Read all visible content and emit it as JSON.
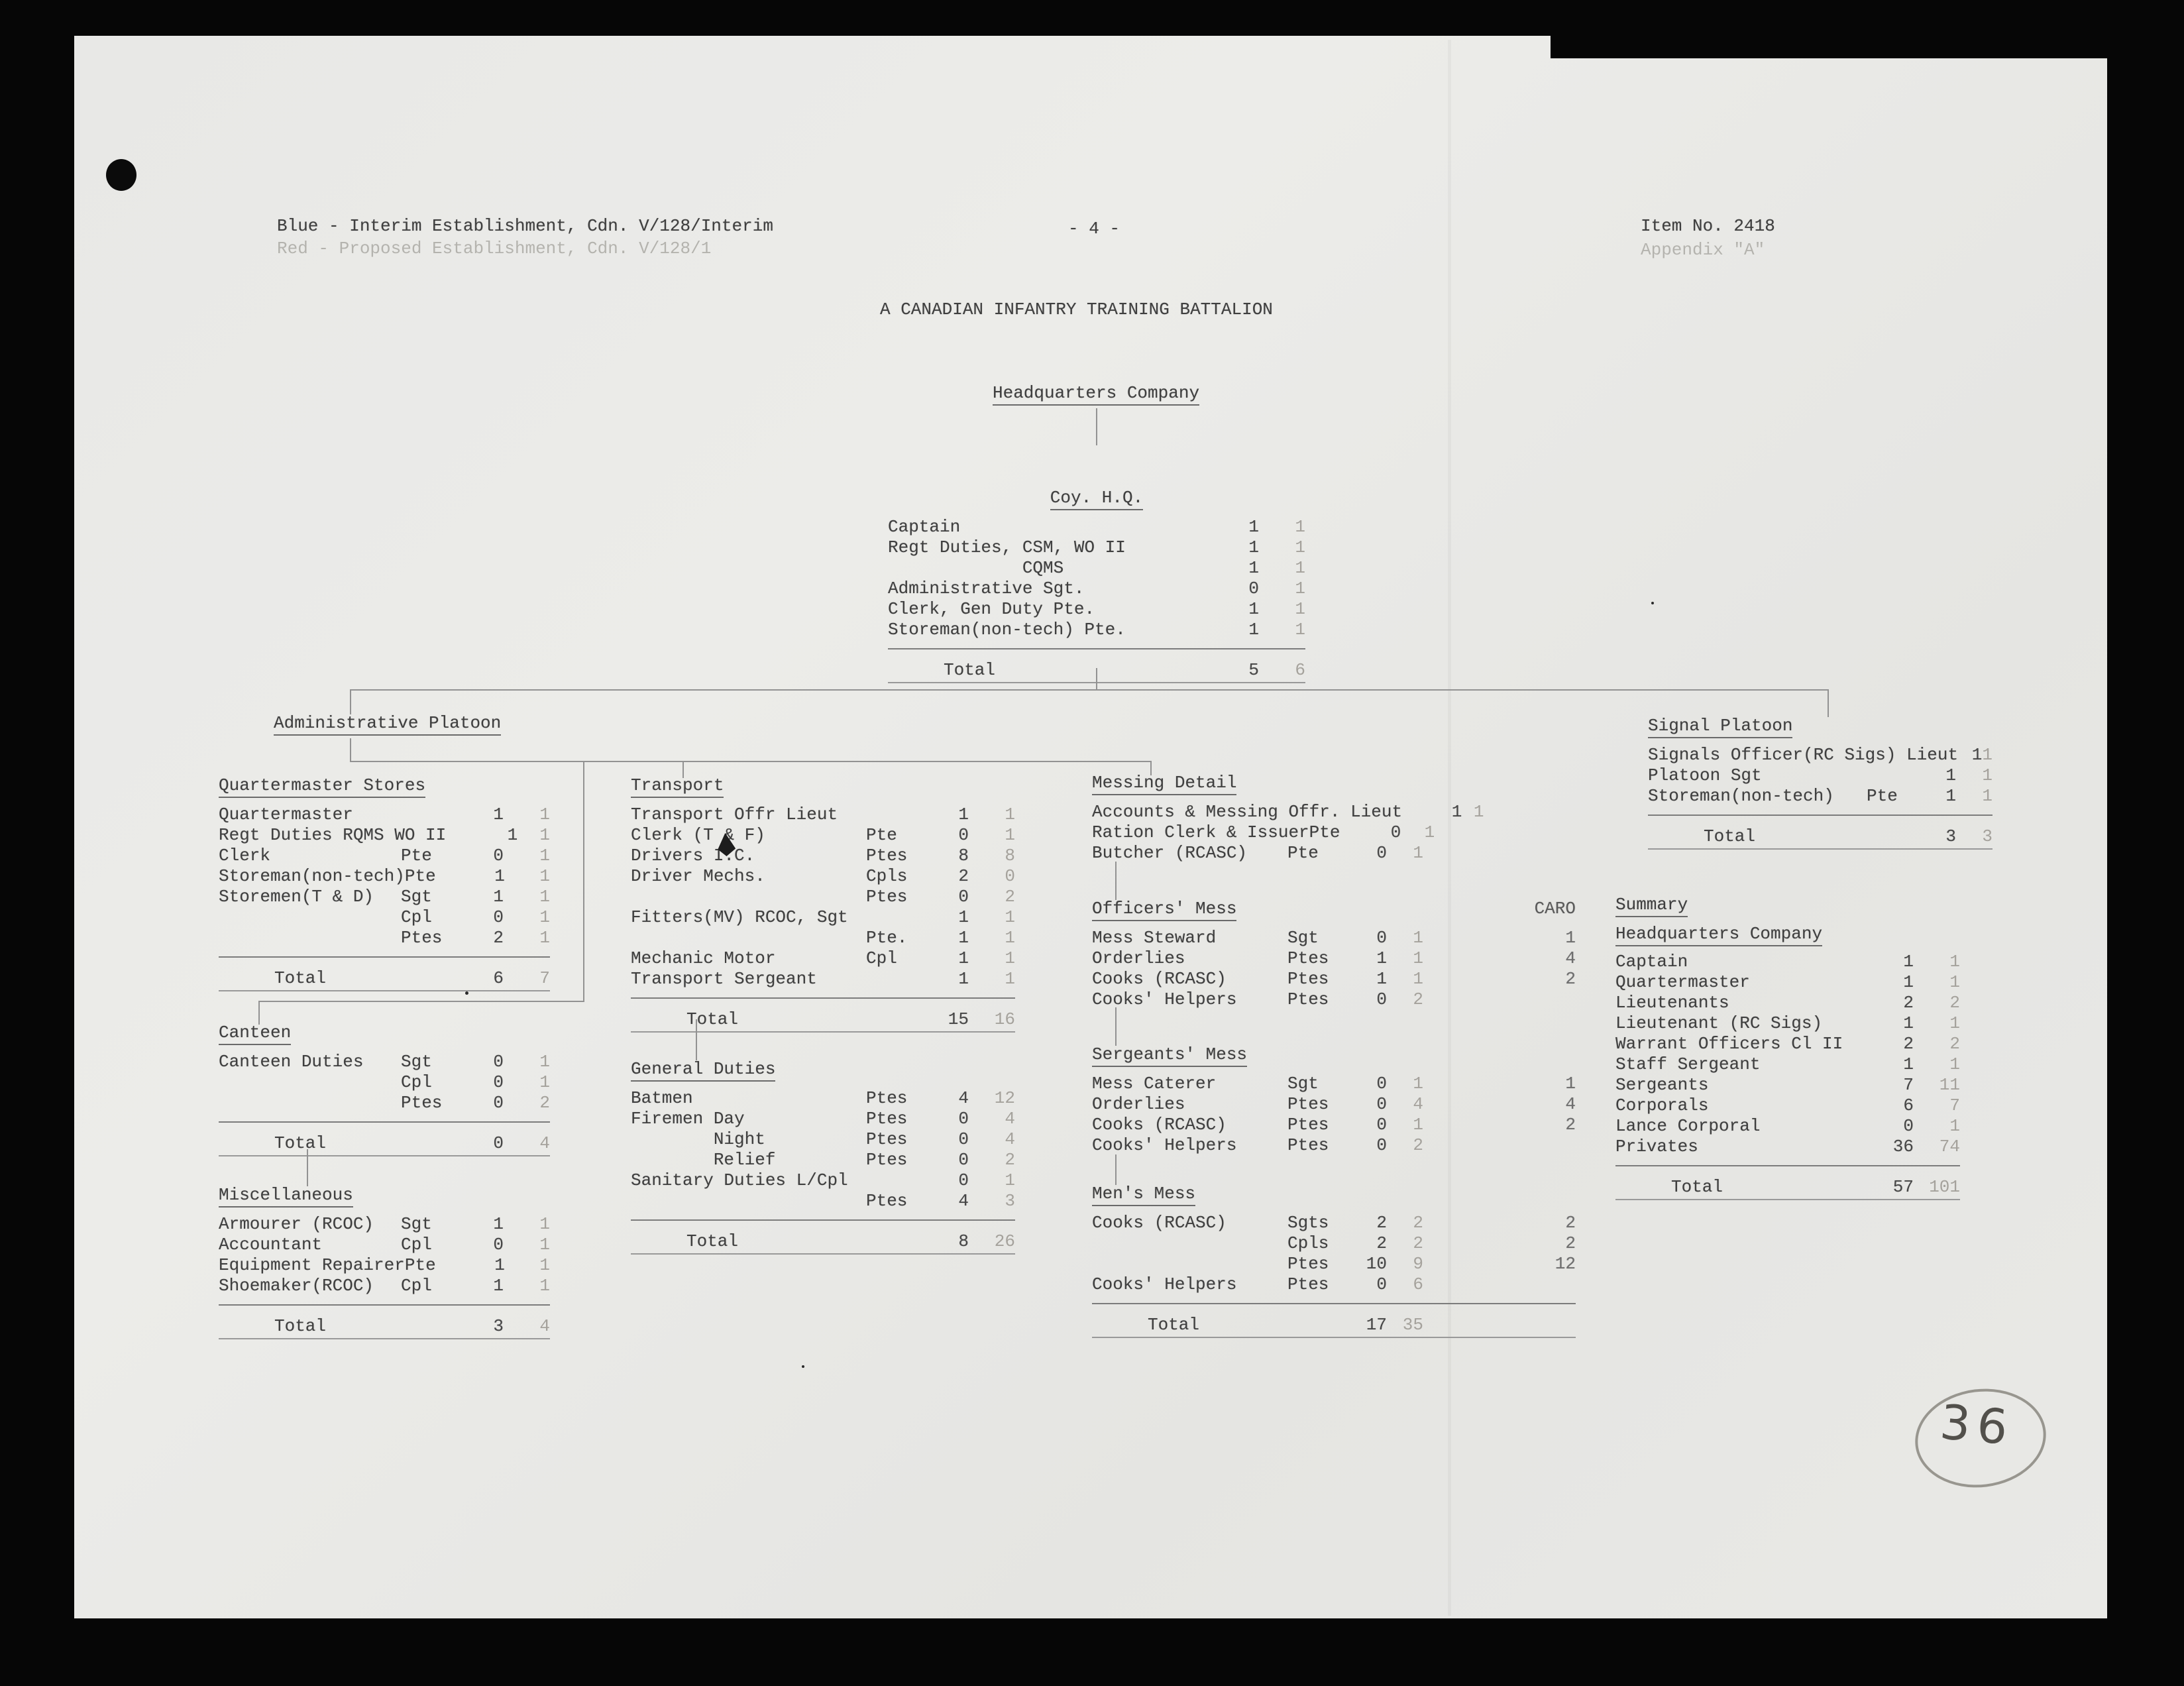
{
  "header": {
    "left_line1": "Blue - Interim Establishment, Cdn. V/128/Interim",
    "left_line2": "Red - Proposed Establishment, Cdn. V/128/1",
    "page_number": "- 4 -",
    "right_line1": "Item No. 2418",
    "right_line2": "Appendix \"A\""
  },
  "title": "A CANADIAN INFANTRY TRAINING BATTALION",
  "org_labels": {
    "hq_company": "Headquarters Company",
    "admin_platoon": "Administrative Platoon"
  },
  "handwritten_note": "36",
  "colors": {
    "paper": "#e8e8e6",
    "ink": "#3f3f3f",
    "faint_ink": "#a5a29c",
    "pencil": "#52504b",
    "frame": "#060606"
  },
  "sections": {
    "coy_hq": {
      "title": "Coy. H.Q.",
      "rows": [
        {
          "label": "Captain",
          "rank": "",
          "c1": "1",
          "c2": "1"
        },
        {
          "label": "Regt Duties, CSM, WO II",
          "rank": "",
          "c1": "1",
          "c2": "1"
        },
        {
          "label": "             CQMS",
          "rank": "",
          "c1": "1",
          "c2": "1"
        },
        {
          "label": "Administrative Sgt.",
          "rank": "",
          "c1": "0",
          "c2": "1"
        },
        {
          "label": "Clerk, Gen Duty Pte.",
          "rank": "",
          "c1": "1",
          "c2": "1"
        },
        {
          "label": "Storeman(non-tech) Pte.",
          "rank": "",
          "c1": "1",
          "c2": "1"
        }
      ],
      "total": {
        "label": "Total",
        "c1": "5",
        "c2": "6"
      }
    },
    "quartermaster_stores": {
      "title": "Quartermaster Stores",
      "rows": [
        {
          "label": "Quartermaster",
          "rank": "",
          "c1": "1",
          "c2": "1"
        },
        {
          "label": "Regt Duties RQMS WO II",
          "rank": "",
          "c1": "1",
          "c2": "1"
        },
        {
          "label": "Clerk",
          "rank": "Pte",
          "c1": "0",
          "c2": "1"
        },
        {
          "label": "Storeman(non-tech)",
          "rank": "Pte",
          "c1": "1",
          "c2": "1"
        },
        {
          "label": "Storemen(T & D)",
          "rank": "Sgt",
          "c1": "1",
          "c2": "1"
        },
        {
          "label": "",
          "rank": "Cpl",
          "c1": "0",
          "c2": "1"
        },
        {
          "label": "",
          "rank": "Ptes",
          "c1": "2",
          "c2": "1"
        }
      ],
      "total": {
        "label": "Total",
        "c1": "6",
        "c2": "7"
      }
    },
    "canteen": {
      "title": "Canteen",
      "rows": [
        {
          "label": "Canteen Duties",
          "rank": "Sgt",
          "c1": "0",
          "c2": "1"
        },
        {
          "label": "",
          "rank": "Cpl",
          "c1": "0",
          "c2": "1"
        },
        {
          "label": "",
          "rank": "Ptes",
          "c1": "0",
          "c2": "2"
        }
      ],
      "total": {
        "label": "Total",
        "c1": "0",
        "c2": "4"
      }
    },
    "miscellaneous": {
      "title": "Miscellaneous",
      "rows": [
        {
          "label": "Armourer (RCOC)",
          "rank": "Sgt",
          "c1": "1",
          "c2": "1"
        },
        {
          "label": "Accountant",
          "rank": "Cpl",
          "c1": "0",
          "c2": "1"
        },
        {
          "label": "Equipment Repairer",
          "rank": "Pte",
          "c1": "1",
          "c2": "1"
        },
        {
          "label": "Shoemaker(RCOC)",
          "rank": "Cpl",
          "c1": "1",
          "c2": "1"
        }
      ],
      "total": {
        "label": "Total",
        "c1": "3",
        "c2": "4"
      }
    },
    "transport": {
      "title": "Transport",
      "rows": [
        {
          "label": "Transport Offr Lieut",
          "rank": "",
          "c1": "1",
          "c2": "1"
        },
        {
          "label": "Clerk (T & F)",
          "rank": "Pte",
          "c1": "0",
          "c2": "1"
        },
        {
          "label": "Drivers I.C.",
          "rank": "Ptes",
          "c1": "8",
          "c2": "8"
        },
        {
          "label": "Driver Mechs.",
          "rank": "Cpls",
          "c1": "2",
          "c2": "0"
        },
        {
          "label": "",
          "rank": "Ptes",
          "c1": "0",
          "c2": "2"
        },
        {
          "label": "Fitters(MV) RCOC, Sgt",
          "rank": "",
          "c1": "1",
          "c2": "1"
        },
        {
          "label": "",
          "rank": "Pte.",
          "c1": "1",
          "c2": "1"
        },
        {
          "label": "Mechanic Motor",
          "rank": "Cpl",
          "c1": "1",
          "c2": "1"
        },
        {
          "label": "Transport Sergeant",
          "rank": "",
          "c1": "1",
          "c2": "1"
        }
      ],
      "total": {
        "label": "Total",
        "c1": "15",
        "c2": "16"
      }
    },
    "general_duties": {
      "title": "General Duties",
      "rows": [
        {
          "label": "Batmen",
          "rank": "Ptes",
          "c1": "4",
          "c2": "12"
        },
        {
          "label": "Firemen Day",
          "rank": "Ptes",
          "c1": "0",
          "c2": "4"
        },
        {
          "label": "        Night",
          "rank": "Ptes",
          "c1": "0",
          "c2": "4"
        },
        {
          "label": "        Relief",
          "rank": "Ptes",
          "c1": "0",
          "c2": "2"
        },
        {
          "label": "Sanitary Duties L/Cpl",
          "rank": "",
          "c1": "0",
          "c2": "1"
        },
        {
          "label": "",
          "rank": "Ptes",
          "c1": "4",
          "c2": "3"
        }
      ],
      "total": {
        "label": "Total",
        "c1": "8",
        "c2": "26"
      }
    },
    "messing_detail": {
      "title": "Messing Detail",
      "rows": [
        {
          "label": "Accounts & Messing Offr. Lieut",
          "rank": "",
          "c1": "1",
          "c2": "1",
          "caro": ""
        },
        {
          "label": "Ration Clerk & Issuer",
          "rank": "Pte",
          "c1": "0",
          "c2": "1",
          "caro": ""
        },
        {
          "label": "Butcher (RCASC)",
          "rank": "Pte",
          "c1": "0",
          "c2": "1",
          "caro": ""
        }
      ]
    },
    "officers_mess": {
      "title": "Officers' Mess",
      "caro_header": "CARO",
      "rows": [
        {
          "label": "Mess Steward",
          "rank": "Sgt",
          "c1": "0",
          "c2": "1",
          "caro": "1"
        },
        {
          "label": "Orderlies",
          "rank": "Ptes",
          "c1": "1",
          "c2": "1",
          "caro": "4"
        },
        {
          "label": "Cooks (RCASC)",
          "rank": "Ptes",
          "c1": "1",
          "c2": "1",
          "caro": "2"
        },
        {
          "label": "Cooks' Helpers",
          "rank": "Ptes",
          "c1": "0",
          "c2": "2",
          "caro": ""
        }
      ]
    },
    "sergeants_mess": {
      "title": "Sergeants' Mess",
      "rows": [
        {
          "label": "Mess Caterer",
          "rank": "Sgt",
          "c1": "0",
          "c2": "1",
          "caro": "1"
        },
        {
          "label": "Orderlies",
          "rank": "Ptes",
          "c1": "0",
          "c2": "4",
          "caro": "4"
        },
        {
          "label": "Cooks (RCASC)",
          "rank": "Ptes",
          "c1": "0",
          "c2": "1",
          "caro": "2"
        },
        {
          "label": "Cooks' Helpers",
          "rank": "Ptes",
          "c1": "0",
          "c2": "2",
          "caro": ""
        }
      ]
    },
    "mens_mess": {
      "title": "Men's Mess",
      "rows": [
        {
          "label": "Cooks (RCASC)",
          "rank": "Sgts",
          "c1": "2",
          "c2": "2",
          "caro": "2"
        },
        {
          "label": "",
          "rank": "Cpls",
          "c1": "2",
          "c2": "2",
          "caro": "2"
        },
        {
          "label": "",
          "rank": "Ptes",
          "c1": "10",
          "c2": "9",
          "caro": "12"
        },
        {
          "label": "Cooks' Helpers",
          "rank": "Ptes",
          "c1": "0",
          "c2": "6",
          "caro": ""
        }
      ],
      "total": {
        "label": "Total",
        "c1": "17",
        "c2": "35"
      }
    },
    "signal_platoon": {
      "title": "Signal Platoon",
      "rows": [
        {
          "label": "Signals Officer(RC Sigs) Lieut",
          "rank": "",
          "c1": "1",
          "c2": "1"
        },
        {
          "label": "Platoon Sgt",
          "rank": "",
          "c1": "1",
          "c2": "1"
        },
        {
          "label": "Storeman(non-tech)",
          "rank": "Pte",
          "c1": "1",
          "c2": "1"
        }
      ],
      "total": {
        "label": "Total",
        "c1": "3",
        "c2": "3"
      }
    },
    "summary": {
      "title": "Summary",
      "subtitle": "Headquarters Company",
      "rows": [
        {
          "label": "Captain",
          "rank": "",
          "c1": "1",
          "c2": "1"
        },
        {
          "label": "Quartermaster",
          "rank": "",
          "c1": "1",
          "c2": "1"
        },
        {
          "label": "Lieutenants",
          "rank": "",
          "c1": "2",
          "c2": "2"
        },
        {
          "label": "Lieutenant (RC Sigs)",
          "rank": "",
          "c1": "1",
          "c2": "1"
        },
        {
          "label": "Warrant Officers Cl II",
          "rank": "",
          "c1": "2",
          "c2": "2"
        },
        {
          "label": "Staff Sergeant",
          "rank": "",
          "c1": "1",
          "c2": "1"
        },
        {
          "label": "Sergeants",
          "rank": "",
          "c1": "7",
          "c2": "11"
        },
        {
          "label": "Corporals",
          "rank": "",
          "c1": "6",
          "c2": "7"
        },
        {
          "label": "Lance Corporal",
          "rank": "",
          "c1": "0",
          "c2": "1"
        },
        {
          "label": "Privates",
          "rank": "",
          "c1": "36",
          "c2": "74"
        }
      ],
      "total": {
        "label": "Total",
        "c1": "57",
        "c2": "101"
      }
    }
  }
}
